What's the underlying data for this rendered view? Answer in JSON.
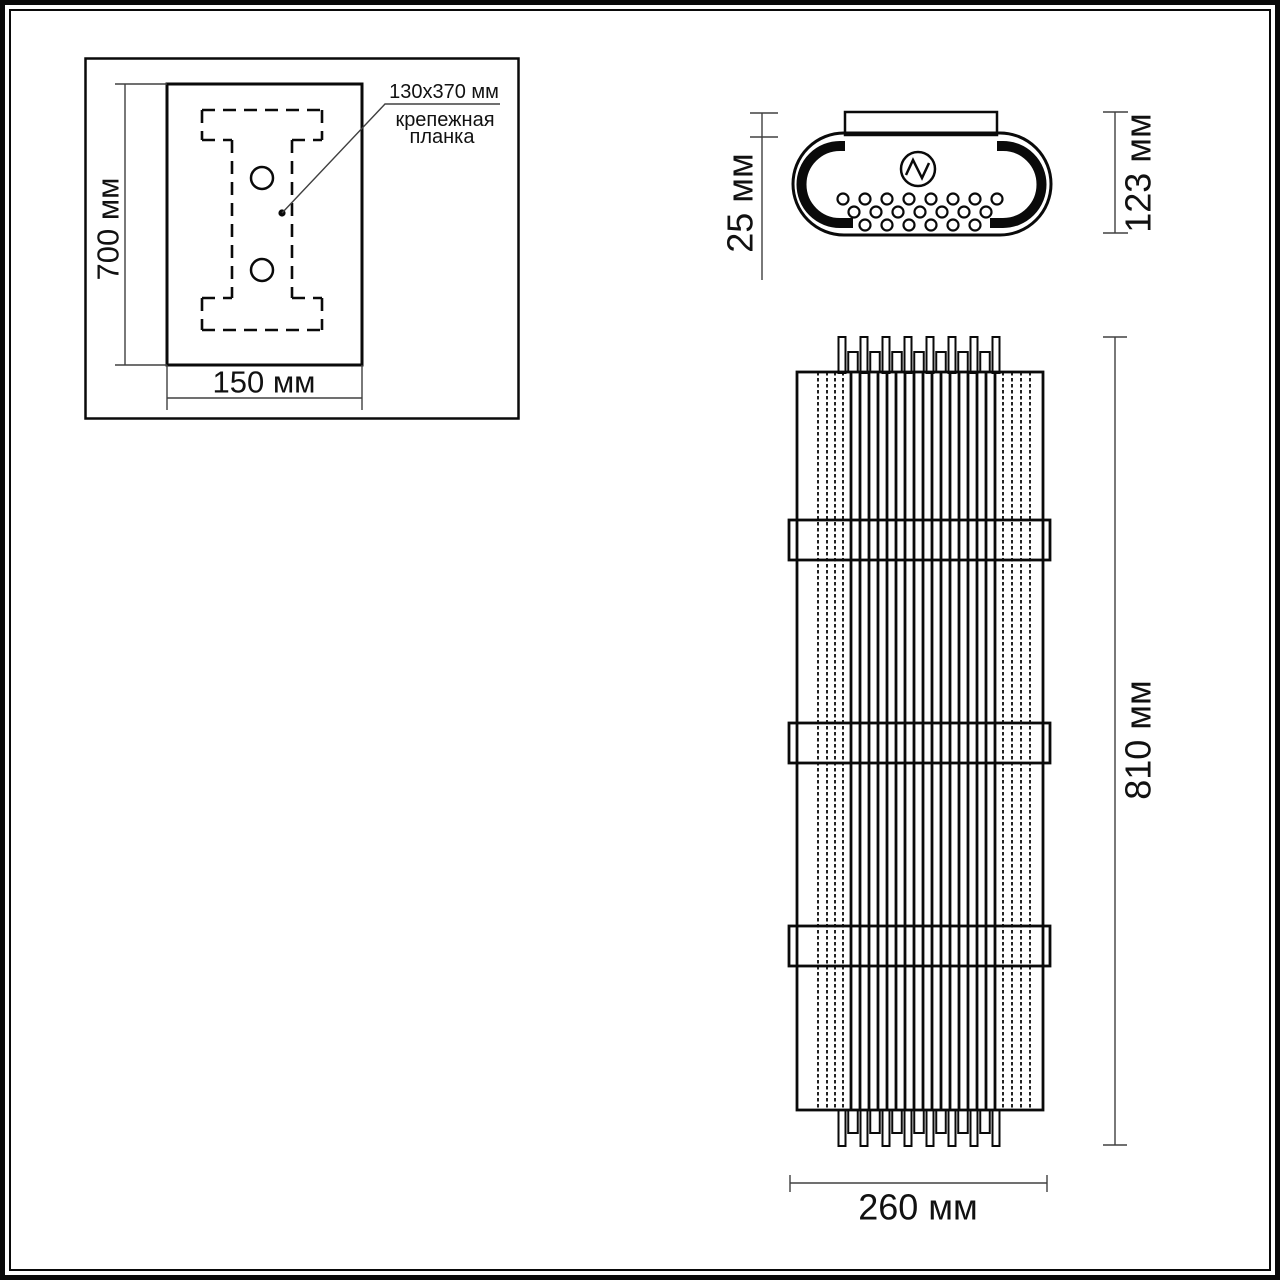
{
  "meta": {
    "background": "#ffffff",
    "line_color": "#0a0a0a",
    "dim_line_color": "#404040"
  },
  "inset": {
    "dim_height_label": "700 мм",
    "dim_width_label": "150 мм",
    "callout_size": "130x370 мм",
    "callout_name1": "крепежная",
    "callout_name2": "планка"
  },
  "top_view": {
    "dim_offset_label": "25 мм",
    "dim_depth_label": "123 мм"
  },
  "front_view": {
    "dim_height_label": "810 мм",
    "dim_width_label": "260 мм"
  }
}
